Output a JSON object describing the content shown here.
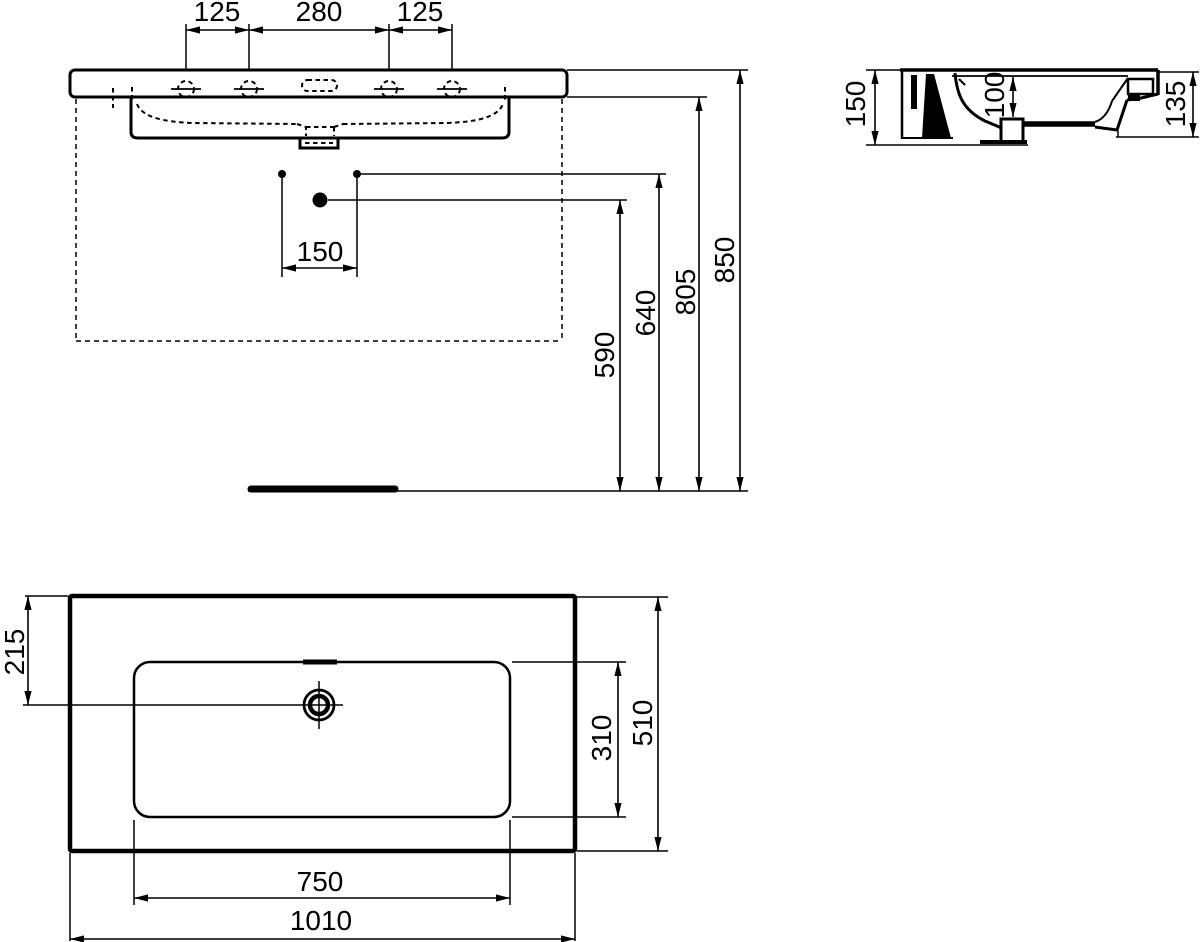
{
  "front_view": {
    "tap_spacing_left": "125",
    "tap_spacing_center": "280",
    "tap_spacing_right": "125",
    "supply_offset": "150",
    "height_590": "590",
    "height_640": "640",
    "height_805": "805",
    "height_850": "850"
  },
  "side_view": {
    "height_150": "150",
    "bowl_depth_100": "100",
    "front_height_135": "135"
  },
  "plan_view": {
    "rim_to_tap_215": "215",
    "bowl_depth_310": "310",
    "total_depth_510": "510",
    "bowl_width_750": "750",
    "total_width_1010": "1010"
  },
  "colors": {
    "line": "#000000",
    "background": "#ffffff"
  }
}
